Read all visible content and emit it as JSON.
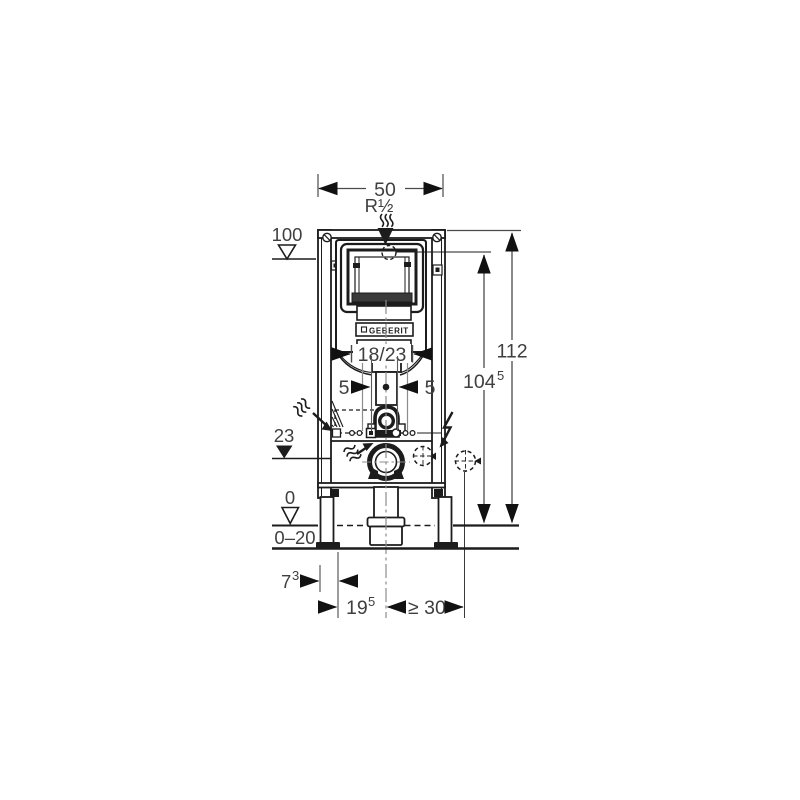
{
  "brand": "GEBERIT",
  "dims": {
    "top_width": "50",
    "supply_thread": "R½",
    "supply_level": "100",
    "plate": "18/23",
    "left_offset": "5",
    "right_offset": "5",
    "total_height": "112",
    "supply_height": {
      "main": "104",
      "sup": "5"
    },
    "outlet_level": "23",
    "floor_level": "0",
    "floor_finish": "0–20",
    "front_depth": {
      "main": "7",
      "sup": "3"
    },
    "drain_offset": {
      "main": "19",
      "sup": "5"
    },
    "side_clearance": "≥ 30"
  },
  "colors": {
    "line": "#1c1c1c",
    "dimension_text": "#3f3f3f",
    "auxiliary": "#8c8c8c",
    "background": "#ffffff"
  }
}
